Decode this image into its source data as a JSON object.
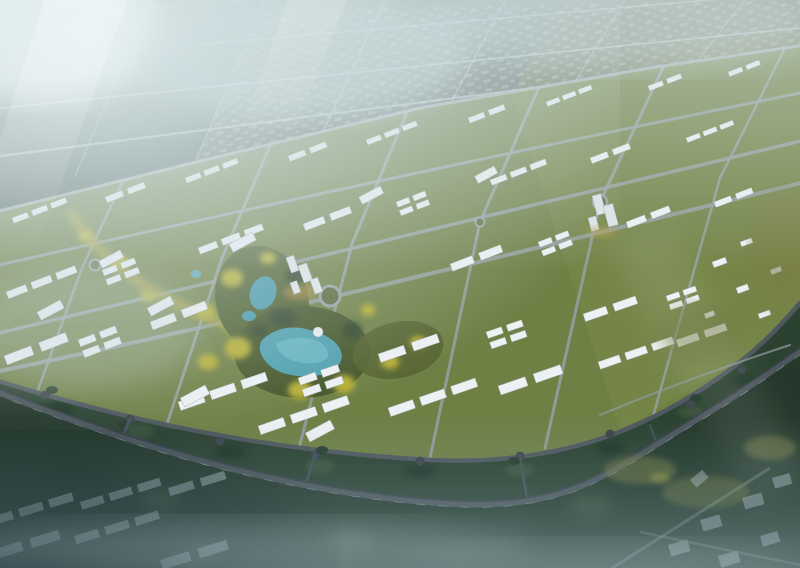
{
  "meta": {
    "type": "architectural-aerial-rendering",
    "description": "Bird's-eye rendering of a planned urban district: arc-shaped fabric of white low-rise buildings on green lots around a central park with teal lakes and golden trees, ringed by a dark curved highway; distant city grid dissolves into cyan fog and light rays at top-left; hazy ghost housing rows in the foreground."
  },
  "scene": {
    "sky": {
      "fog": "#dce9eb",
      "base_top": "#b6c8cb",
      "base_mid": "#5f7360",
      "base_bottom": "#2a3f35"
    },
    "far_city": {
      "base": "#4b5c52",
      "left_block": "#415349",
      "mid_block": "#55645a",
      "right_block": "#636c4e",
      "warm_patch": "#958f55",
      "road": "#ccdadd"
    },
    "district": {
      "lawn": "#6f8045",
      "lawn_right": "#7b8a4b",
      "building": "#eef1f3",
      "building_edge": "#a9b5bb",
      "road": "#95a1a4",
      "boundary_road": "#a6b2b4"
    },
    "park": {
      "green": "#46572b",
      "green_light": "#556430",
      "gold_trees": "#b6ad35",
      "dark_trees": "#32472b",
      "lake": "#4fa0b0",
      "lake_light": "#77c2cb",
      "dome_roof": "#e8edef"
    },
    "lowland": {
      "tree_band": "#2b4231",
      "ground": "#24392b",
      "gold_ground": "#77803f"
    },
    "highway": {
      "casing": "#39434a",
      "surface": "#4d575d",
      "dash": "#b9c6c9",
      "ring_road": "#4e585e"
    },
    "haze": {
      "bottom": "#8ba6b2",
      "ghost_house": "#b7c8ce",
      "ghost_road": "#a4b7bf",
      "ray": "#ffffff"
    }
  }
}
